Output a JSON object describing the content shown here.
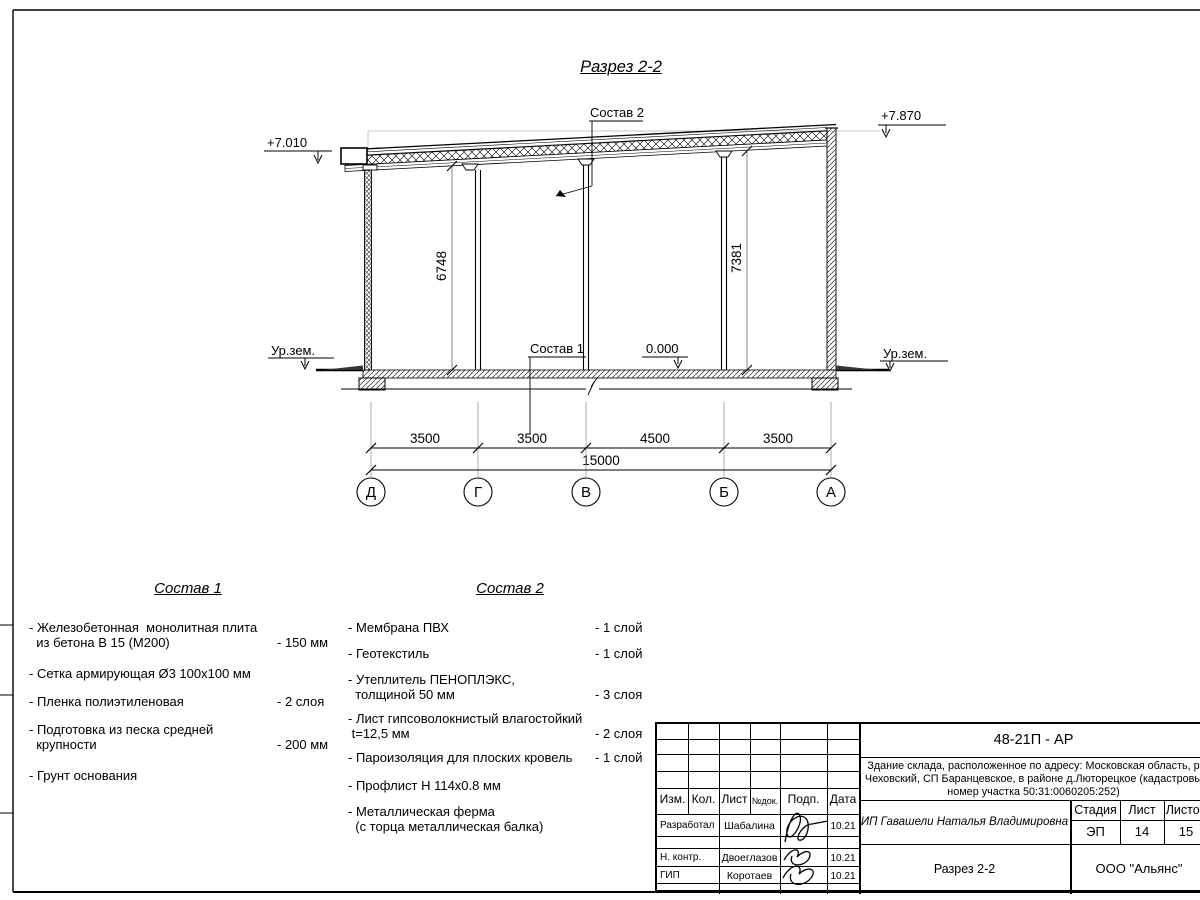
{
  "sheet": {
    "title": "Разрез 2-2"
  },
  "marks": {
    "elev_left": "+7.010",
    "elev_right": "+7.870",
    "elev_zero": "0.000",
    "ground_left": "Ур.зем.",
    "ground_right": "Ур.зем.",
    "dim_height_left": "6748",
    "dim_height_right": "7381",
    "leader_roof": "Состав 2",
    "leader_floor": "Состав 1"
  },
  "dims": {
    "segments": [
      "3500",
      "3500",
      "4500",
      "3500"
    ],
    "total": "15000"
  },
  "axes": [
    "Д",
    "Г",
    "В",
    "Б",
    "А"
  ],
  "sostav1": {
    "title": "Состав 1",
    "items": [
      {
        "text": "- Железобетонная  монолитная плита\n  из бетона В 15 (М200)",
        "value": "- 150 мм"
      },
      {
        "text": "- Сетка армирующая Ø3 100х100 мм",
        "value": ""
      },
      {
        "text": "- Пленка полиэтиленовая",
        "value": "-  2 слоя"
      },
      {
        "text": "- Подготовка из песка средней\n  крупности",
        "value": "- 200 мм"
      },
      {
        "text": "- Грунт основания",
        "value": ""
      }
    ]
  },
  "sostav2": {
    "title": "Состав 2",
    "items": [
      {
        "text": "- Мембрана ПВХ",
        "value": "- 1 слой"
      },
      {
        "text": "- Геотекстиль",
        "value": "- 1 слой"
      },
      {
        "text": "- Утеплитель ПЕНОПЛЭКС,\n  толщиной 50 мм",
        "value": "- 3 слоя"
      },
      {
        "text": "- Лист гипсоволокнистый влагостойкий\n t=12,5 мм",
        "value": "- 2 слоя"
      },
      {
        "text": "- Пароизоляция для плоских кровель",
        "value": "- 1 слой"
      },
      {
        "text": "- Профлист Н 114х0.8 мм",
        "value": ""
      },
      {
        "text": "- Металлическая ферма\n  (с торца металлическая балка)",
        "value": ""
      }
    ]
  },
  "titleblock": {
    "doc_code": "48-21П - АР",
    "address_line1": "Здание склада, расположенное по адресу: Московская область, р",
    "address_line2": "Чеховский, СП Баранцевское, в районе д.Люторецкое  (кадастровы",
    "address_line3": "номер участка 50:31:0060205:252)",
    "col_izm": "Изм.",
    "col_kol": "Кол.",
    "col_list": "Лист",
    "col_ndok": "№док.",
    "col_podp": "Подп.",
    "col_data": "Дата",
    "rows": [
      {
        "role": "Разработал",
        "name": "Шабалина",
        "date": "10.21"
      },
      {
        "role": "Н. контр.",
        "name": "Двоеглазов",
        "date": "10.21"
      },
      {
        "role": "ГИП",
        "name": "Коротаев",
        "date": "10.21"
      }
    ],
    "client": "ИП Гавашели Наталья Владимировна",
    "stage_label": "Стадия",
    "sheet_label": "Лист",
    "sheets_label": "Листов",
    "stage": "ЭП",
    "sheet_num": "14",
    "sheets_total": "15",
    "drawing_name": "Разрез 2-2",
    "company": "ООО \"Альянс\""
  }
}
